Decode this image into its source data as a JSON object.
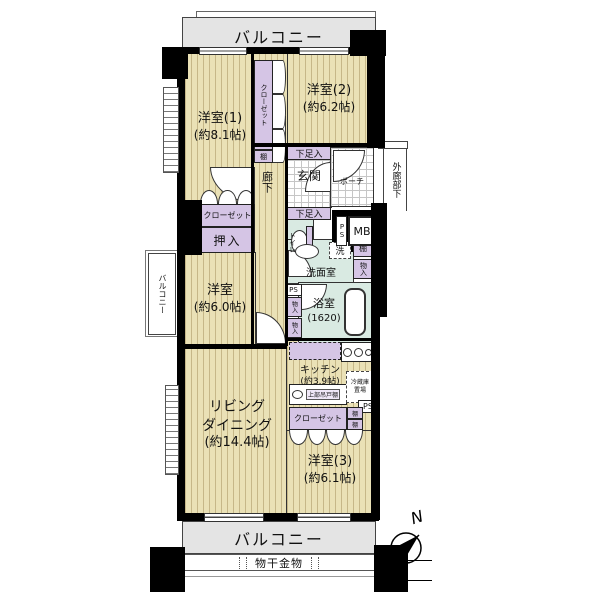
{
  "plan": {
    "balcony_top": "バルコニー",
    "balcony_bottom": "バルコニー",
    "balcony_left": "バルコニー",
    "laundry_hardware": "物干金物",
    "compass_n": "N"
  },
  "rooms": {
    "western1_name": "洋室(1)",
    "western1_size": "(約8.1帖)",
    "western2_name": "洋室(2)",
    "western2_size": "(約6.2帖)",
    "western3_name": "洋室(3)",
    "western3_size": "(約6.1帖)",
    "western_mid_name": "洋室",
    "western_mid_size": "(約6.0帖)",
    "living_line1": "リビング",
    "living_line2": "ダイニング",
    "living_size": "(約14.4帖)",
    "kitchen_name": "キッチン",
    "kitchen_size": "(約3.9帖)",
    "bath_name": "浴室",
    "bath_size": "(1620)",
    "washroom": "洗面室",
    "toilet": "トイレ",
    "genkan": "玄関",
    "corridor": "廊下",
    "porch": "ポーチ",
    "outer_corridor": "外廊部下"
  },
  "storage": {
    "closet": "クローゼット",
    "oshiire": "押入",
    "shoe_box": "下足入",
    "shelf": "棚",
    "mono_iri": "物入",
    "fridge_space_1": "冷蔵庫",
    "fridge_space_2": "置場",
    "hanging_cupboard": "上部吊戸棚",
    "laundry": "洗"
  },
  "utility": {
    "mb": "MB",
    "ps": "PS"
  }
}
